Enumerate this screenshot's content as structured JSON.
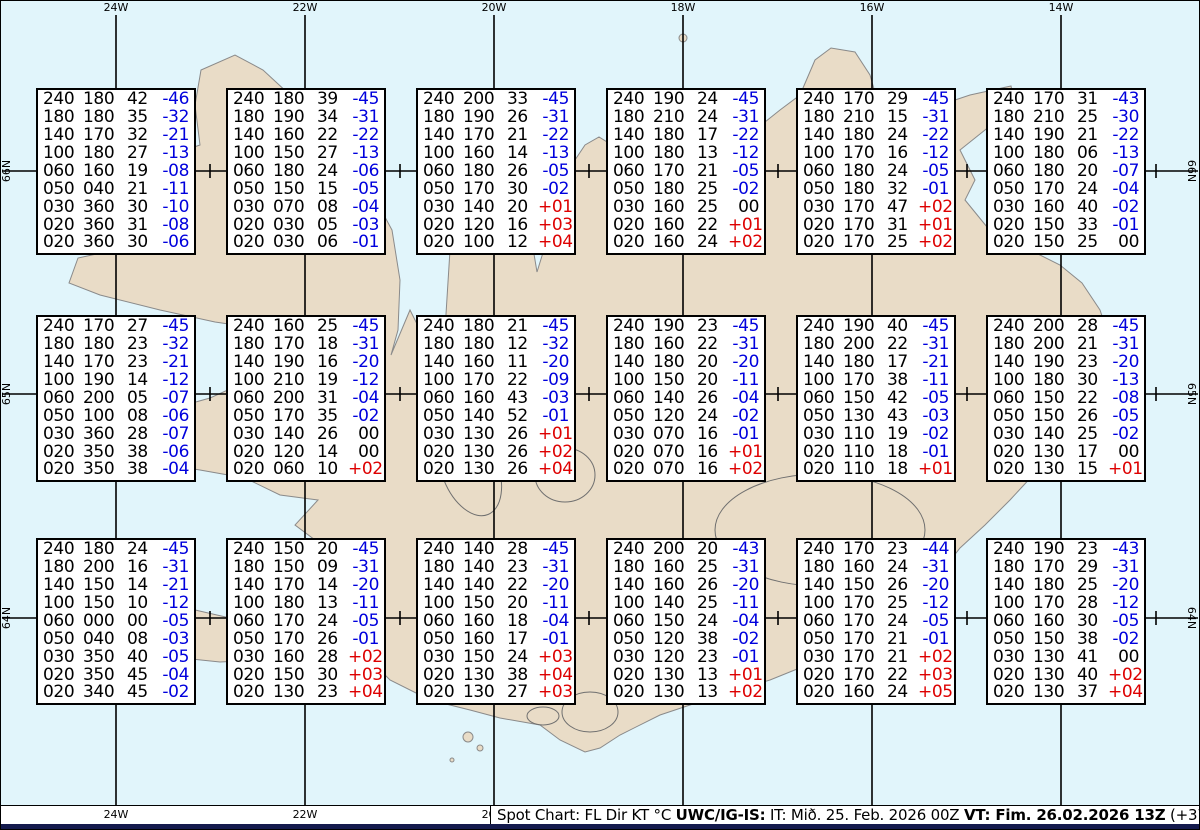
{
  "colors": {
    "water": "#e1f5fb",
    "land": "#e9dcc7",
    "coast": "#8a8a8a",
    "glacier": "#6f6f6f",
    "grid_line": "#000000",
    "temp_negative": "#0000dd",
    "temp_positive": "#dd0000",
    "navy_bar": "#141a4d"
  },
  "grid": {
    "meridians": [
      {
        "label": "24W",
        "x": 116
      },
      {
        "label": "22W",
        "x": 305
      },
      {
        "label": "20W",
        "x": 494
      },
      {
        "label": "18W",
        "x": 683
      },
      {
        "label": "16W",
        "x": 872
      },
      {
        "label": "14W",
        "x": 1061
      }
    ],
    "parallels": [
      {
        "label": "66N",
        "y": 171
      },
      {
        "label": "65N",
        "y": 394
      },
      {
        "label": "64N",
        "y": 618
      }
    ],
    "tick_xs": [
      210,
      400,
      589,
      778,
      967,
      1156
    ]
  },
  "chart_data": {
    "type": "table",
    "title": "Spot Chart: FL Dir KT °C",
    "columns": [
      "FL",
      "Dir",
      "KT",
      "°C"
    ],
    "grid_rows": 3,
    "grid_cols": 6,
    "stations": [
      {
        "rows": [
          [
            "240",
            "180",
            "42",
            "-46"
          ],
          [
            "180",
            "180",
            "35",
            "-32"
          ],
          [
            "140",
            "170",
            "32",
            "-21"
          ],
          [
            "100",
            "180",
            "27",
            "-13"
          ],
          [
            "060",
            "160",
            "19",
            "-08"
          ],
          [
            "050",
            "040",
            "21",
            "-11"
          ],
          [
            "030",
            "360",
            "30",
            "-10"
          ],
          [
            "020",
            "360",
            "31",
            "-08"
          ],
          [
            "020",
            "360",
            "30",
            "-06"
          ]
        ]
      },
      {
        "rows": [
          [
            "240",
            "180",
            "39",
            "-45"
          ],
          [
            "180",
            "190",
            "34",
            "-31"
          ],
          [
            "140",
            "160",
            "22",
            "-22"
          ],
          [
            "100",
            "150",
            "27",
            "-13"
          ],
          [
            "060",
            "180",
            "24",
            "-06"
          ],
          [
            "050",
            "150",
            "15",
            "-05"
          ],
          [
            "030",
            "070",
            "08",
            "-04"
          ],
          [
            "020",
            "030",
            "05",
            "-03"
          ],
          [
            "020",
            "030",
            "06",
            "-01"
          ]
        ]
      },
      {
        "rows": [
          [
            "240",
            "200",
            "33",
            "-45"
          ],
          [
            "180",
            "190",
            "26",
            "-31"
          ],
          [
            "140",
            "170",
            "21",
            "-22"
          ],
          [
            "100",
            "160",
            "14",
            "-13"
          ],
          [
            "060",
            "180",
            "26",
            "-05"
          ],
          [
            "050",
            "170",
            "30",
            "-02"
          ],
          [
            "030",
            "140",
            "20",
            "+01"
          ],
          [
            "020",
            "120",
            "16",
            "+03"
          ],
          [
            "020",
            "100",
            "12",
            "+04"
          ]
        ]
      },
      {
        "rows": [
          [
            "240",
            "190",
            "24",
            "-45"
          ],
          [
            "180",
            "210",
            "24",
            "-31"
          ],
          [
            "140",
            "180",
            "17",
            "-22"
          ],
          [
            "100",
            "180",
            "13",
            "-12"
          ],
          [
            "060",
            "170",
            "21",
            "-05"
          ],
          [
            "050",
            "180",
            "25",
            "-02"
          ],
          [
            "030",
            "160",
            "25",
            "00"
          ],
          [
            "020",
            "160",
            "22",
            "+01"
          ],
          [
            "020",
            "160",
            "24",
            "+02"
          ]
        ]
      },
      {
        "rows": [
          [
            "240",
            "170",
            "29",
            "-45"
          ],
          [
            "180",
            "210",
            "15",
            "-31"
          ],
          [
            "140",
            "180",
            "24",
            "-22"
          ],
          [
            "100",
            "170",
            "16",
            "-12"
          ],
          [
            "060",
            "180",
            "24",
            "-05"
          ],
          [
            "050",
            "180",
            "32",
            "-01"
          ],
          [
            "030",
            "170",
            "47",
            "+02"
          ],
          [
            "020",
            "170",
            "31",
            "+01"
          ],
          [
            "020",
            "170",
            "25",
            "+02"
          ]
        ]
      },
      {
        "rows": [
          [
            "240",
            "170",
            "31",
            "-43"
          ],
          [
            "180",
            "210",
            "25",
            "-30"
          ],
          [
            "140",
            "190",
            "21",
            "-22"
          ],
          [
            "100",
            "180",
            "06",
            "-13"
          ],
          [
            "060",
            "180",
            "20",
            "-07"
          ],
          [
            "050",
            "170",
            "24",
            "-04"
          ],
          [
            "030",
            "160",
            "40",
            "-02"
          ],
          [
            "020",
            "150",
            "33",
            "-01"
          ],
          [
            "020",
            "150",
            "25",
            "00"
          ]
        ]
      },
      {
        "rows": [
          [
            "240",
            "170",
            "27",
            "-45"
          ],
          [
            "180",
            "180",
            "23",
            "-32"
          ],
          [
            "140",
            "170",
            "23",
            "-21"
          ],
          [
            "100",
            "190",
            "14",
            "-12"
          ],
          [
            "060",
            "200",
            "05",
            "-07"
          ],
          [
            "050",
            "100",
            "08",
            "-06"
          ],
          [
            "030",
            "360",
            "28",
            "-07"
          ],
          [
            "020",
            "350",
            "38",
            "-06"
          ],
          [
            "020",
            "350",
            "38",
            "-04"
          ]
        ]
      },
      {
        "rows": [
          [
            "240",
            "160",
            "25",
            "-45"
          ],
          [
            "180",
            "170",
            "18",
            "-31"
          ],
          [
            "140",
            "190",
            "16",
            "-20"
          ],
          [
            "100",
            "210",
            "19",
            "-12"
          ],
          [
            "060",
            "200",
            "31",
            "-04"
          ],
          [
            "050",
            "170",
            "35",
            "-02"
          ],
          [
            "030",
            "140",
            "26",
            "00"
          ],
          [
            "020",
            "120",
            "14",
            "00"
          ],
          [
            "020",
            "060",
            "10",
            "+02"
          ]
        ]
      },
      {
        "rows": [
          [
            "240",
            "180",
            "21",
            "-45"
          ],
          [
            "180",
            "180",
            "12",
            "-32"
          ],
          [
            "140",
            "160",
            "11",
            "-20"
          ],
          [
            "100",
            "170",
            "22",
            "-09"
          ],
          [
            "060",
            "160",
            "43",
            "-03"
          ],
          [
            "050",
            "140",
            "52",
            "-01"
          ],
          [
            "030",
            "130",
            "26",
            "+01"
          ],
          [
            "020",
            "130",
            "26",
            "+02"
          ],
          [
            "020",
            "130",
            "26",
            "+04"
          ]
        ]
      },
      {
        "rows": [
          [
            "240",
            "190",
            "23",
            "-45"
          ],
          [
            "180",
            "160",
            "22",
            "-31"
          ],
          [
            "140",
            "180",
            "20",
            "-20"
          ],
          [
            "100",
            "150",
            "20",
            "-11"
          ],
          [
            "060",
            "140",
            "26",
            "-04"
          ],
          [
            "050",
            "120",
            "24",
            "-02"
          ],
          [
            "030",
            "070",
            "16",
            "-01"
          ],
          [
            "020",
            "070",
            "16",
            "+01"
          ],
          [
            "020",
            "070",
            "16",
            "+02"
          ]
        ]
      },
      {
        "rows": [
          [
            "240",
            "190",
            "40",
            "-45"
          ],
          [
            "180",
            "200",
            "22",
            "-31"
          ],
          [
            "140",
            "180",
            "17",
            "-21"
          ],
          [
            "100",
            "170",
            "38",
            "-11"
          ],
          [
            "060",
            "150",
            "42",
            "-05"
          ],
          [
            "050",
            "130",
            "43",
            "-03"
          ],
          [
            "030",
            "110",
            "19",
            "-02"
          ],
          [
            "020",
            "110",
            "18",
            "-01"
          ],
          [
            "020",
            "110",
            "18",
            "+01"
          ]
        ]
      },
      {
        "rows": [
          [
            "240",
            "200",
            "28",
            "-45"
          ],
          [
            "180",
            "200",
            "21",
            "-31"
          ],
          [
            "140",
            "190",
            "23",
            "-20"
          ],
          [
            "100",
            "180",
            "30",
            "-13"
          ],
          [
            "060",
            "150",
            "22",
            "-08"
          ],
          [
            "050",
            "150",
            "26",
            "-05"
          ],
          [
            "030",
            "140",
            "25",
            "-02"
          ],
          [
            "020",
            "130",
            "17",
            "00"
          ],
          [
            "020",
            "130",
            "15",
            "+01"
          ]
        ]
      },
      {
        "rows": [
          [
            "240",
            "180",
            "24",
            "-45"
          ],
          [
            "180",
            "200",
            "16",
            "-31"
          ],
          [
            "140",
            "150",
            "14",
            "-21"
          ],
          [
            "100",
            "150",
            "10",
            "-12"
          ],
          [
            "060",
            "000",
            "00",
            "-05"
          ],
          [
            "050",
            "040",
            "08",
            "-03"
          ],
          [
            "030",
            "350",
            "40",
            "-05"
          ],
          [
            "020",
            "350",
            "45",
            "-04"
          ],
          [
            "020",
            "340",
            "45",
            "-02"
          ]
        ]
      },
      {
        "rows": [
          [
            "240",
            "150",
            "20",
            "-45"
          ],
          [
            "180",
            "150",
            "09",
            "-31"
          ],
          [
            "140",
            "170",
            "14",
            "-20"
          ],
          [
            "100",
            "180",
            "13",
            "-11"
          ],
          [
            "060",
            "170",
            "24",
            "-05"
          ],
          [
            "050",
            "170",
            "26",
            "-01"
          ],
          [
            "030",
            "160",
            "28",
            "+02"
          ],
          [
            "020",
            "150",
            "30",
            "+03"
          ],
          [
            "020",
            "130",
            "23",
            "+04"
          ]
        ]
      },
      {
        "rows": [
          [
            "240",
            "140",
            "28",
            "-45"
          ],
          [
            "180",
            "140",
            "23",
            "-31"
          ],
          [
            "140",
            "140",
            "22",
            "-20"
          ],
          [
            "100",
            "150",
            "20",
            "-11"
          ],
          [
            "060",
            "160",
            "18",
            "-04"
          ],
          [
            "050",
            "160",
            "17",
            "-01"
          ],
          [
            "030",
            "150",
            "24",
            "+03"
          ],
          [
            "020",
            "130",
            "38",
            "+04"
          ],
          [
            "020",
            "130",
            "27",
            "+03"
          ]
        ]
      },
      {
        "rows": [
          [
            "240",
            "200",
            "20",
            "-43"
          ],
          [
            "180",
            "160",
            "25",
            "-31"
          ],
          [
            "140",
            "160",
            "26",
            "-20"
          ],
          [
            "100",
            "140",
            "25",
            "-11"
          ],
          [
            "060",
            "150",
            "24",
            "-04"
          ],
          [
            "050",
            "120",
            "38",
            "-02"
          ],
          [
            "030",
            "120",
            "23",
            "-01"
          ],
          [
            "020",
            "130",
            "13",
            "+01"
          ],
          [
            "020",
            "130",
            "13",
            "+02"
          ]
        ]
      },
      {
        "rows": [
          [
            "240",
            "170",
            "23",
            "-44"
          ],
          [
            "180",
            "160",
            "24",
            "-31"
          ],
          [
            "140",
            "150",
            "26",
            "-20"
          ],
          [
            "100",
            "170",
            "25",
            "-12"
          ],
          [
            "060",
            "170",
            "24",
            "-05"
          ],
          [
            "050",
            "170",
            "21",
            "-01"
          ],
          [
            "030",
            "170",
            "21",
            "+02"
          ],
          [
            "020",
            "170",
            "22",
            "+03"
          ],
          [
            "020",
            "160",
            "24",
            "+05"
          ]
        ]
      },
      {
        "rows": [
          [
            "240",
            "190",
            "23",
            "-43"
          ],
          [
            "180",
            "170",
            "29",
            "-31"
          ],
          [
            "140",
            "180",
            "25",
            "-20"
          ],
          [
            "100",
            "170",
            "28",
            "-12"
          ],
          [
            "060",
            "160",
            "30",
            "-05"
          ],
          [
            "050",
            "150",
            "38",
            "-02"
          ],
          [
            "030",
            "130",
            "41",
            "00"
          ],
          [
            "020",
            "130",
            "40",
            "+02"
          ],
          [
            "020",
            "130",
            "37",
            "+04"
          ]
        ]
      }
    ]
  },
  "caption": {
    "segments": [
      {
        "text": "Spot Chart: FL Dir KT °C ",
        "bold": false
      },
      {
        "text": "UWC/IG-IS:",
        "bold": true
      },
      {
        "text": " IT: Mið. 25. Feb. 2026 00Z ",
        "bold": false
      },
      {
        "text": "VT: Fim. 26.02.2026 13Z",
        "bold": true
      },
      {
        "text": " (+37 h)",
        "bold": false
      }
    ]
  }
}
